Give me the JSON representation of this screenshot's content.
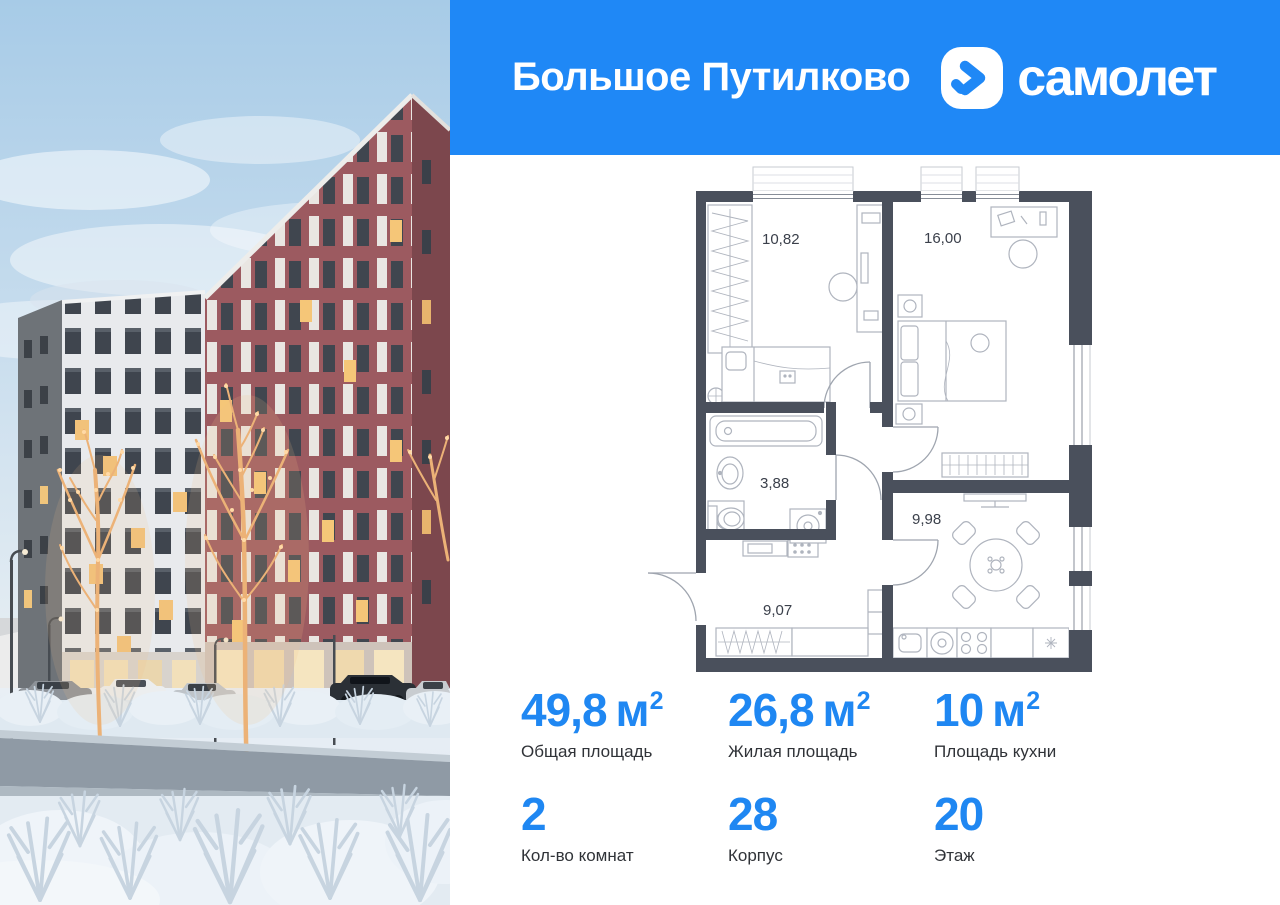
{
  "header": {
    "project_name": "Большое Путилково",
    "brand_name": "самолет",
    "background_color": "#1F88F6"
  },
  "photo": {
    "scene": "winter courtyard of the residential complex: brick and grey towers, trees wrapped in warm lights, parked cars, snowy road and frosted shrubs"
  },
  "floor_plan": {
    "wall_color": "#4A505C",
    "rooms": [
      {
        "id": "bedroom-1",
        "area": "10,82"
      },
      {
        "id": "bedroom-2",
        "area": "16,00"
      },
      {
        "id": "bathroom",
        "area": "3,88"
      },
      {
        "id": "kitchen",
        "area": "9,98"
      },
      {
        "id": "hallway",
        "area": "9,07"
      }
    ]
  },
  "stats": {
    "accent_color": "#1F87F2",
    "items": [
      {
        "value": "49,8",
        "unit": "м",
        "sup": "2",
        "label": "Общая площадь"
      },
      {
        "value": "26,8",
        "unit": "м",
        "sup": "2",
        "label": "Жилая площадь"
      },
      {
        "value": "10",
        "unit": "м",
        "sup": "2",
        "label": "Площадь кухни"
      },
      {
        "value": "2",
        "unit": "",
        "sup": "",
        "label": "Кол-во комнат"
      },
      {
        "value": "28",
        "unit": "",
        "sup": "",
        "label": "Корпус"
      },
      {
        "value": "20",
        "unit": "",
        "sup": "",
        "label": "Этаж"
      }
    ]
  }
}
